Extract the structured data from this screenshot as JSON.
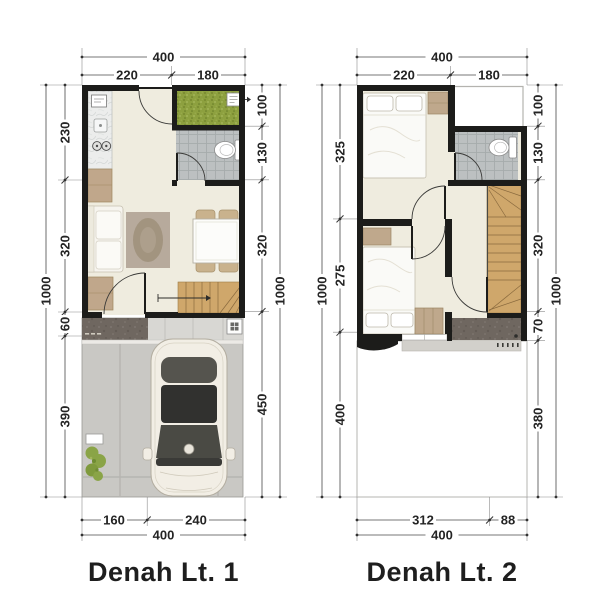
{
  "plans": [
    {
      "title": "Denah Lt. 1",
      "dims": {
        "top": {
          "total": "400",
          "segments": [
            "220",
            "180"
          ]
        },
        "bottom": {
          "total": "400",
          "segments": [
            "160",
            "240"
          ]
        },
        "left": {
          "overall": "1000",
          "segments": [
            "230",
            "320",
            "60",
            "390"
          ]
        },
        "right": {
          "overall": "1000",
          "segments": [
            "100",
            "130",
            "320",
            "450"
          ]
        }
      },
      "symbols": [
        "kitchen-counter",
        "service-yard-grass",
        "bathroom-toilet",
        "back-door",
        "sofa",
        "rug",
        "dining-table-4-chairs",
        "stairs-up",
        "entry-door",
        "entry-porch",
        "drain-box",
        "carport",
        "car-top-view",
        "plant"
      ]
    },
    {
      "title": "Denah Lt. 2",
      "dims": {
        "top": {
          "total": "400",
          "segments": [
            "220",
            "180"
          ]
        },
        "bottom": {
          "total": "400",
          "segments": [
            "312",
            "88"
          ]
        },
        "left": {
          "overall": "1000",
          "segments": [
            "325",
            "275",
            "400"
          ]
        },
        "right": {
          "overall": "1000",
          "segments": [
            "100",
            "130",
            "320",
            "70",
            "380"
          ]
        }
      },
      "symbols": [
        "bed-double",
        "bedside-cabinet",
        "window",
        "void-over-yard",
        "bathroom-toilet",
        "bedroom-doors",
        "bed-double-2",
        "wardrobe",
        "stairs-winder",
        "landing-dark-tile",
        "void-over-carport"
      ]
    }
  ],
  "colors": {
    "wall": "#1c1c1a",
    "floor": "#efecdf",
    "grass": "#8da03f",
    "bath_tile": "#bcc0c1",
    "wood_stairs": "#cfa76b",
    "furniture_tan": "#c0a78b",
    "porch_dark_tile": "#6f6760",
    "carport_concrete": "#c9c8c4",
    "car_body": "#f2eee5",
    "car_glass": "#4a4a44",
    "dim_text": "#242424"
  }
}
